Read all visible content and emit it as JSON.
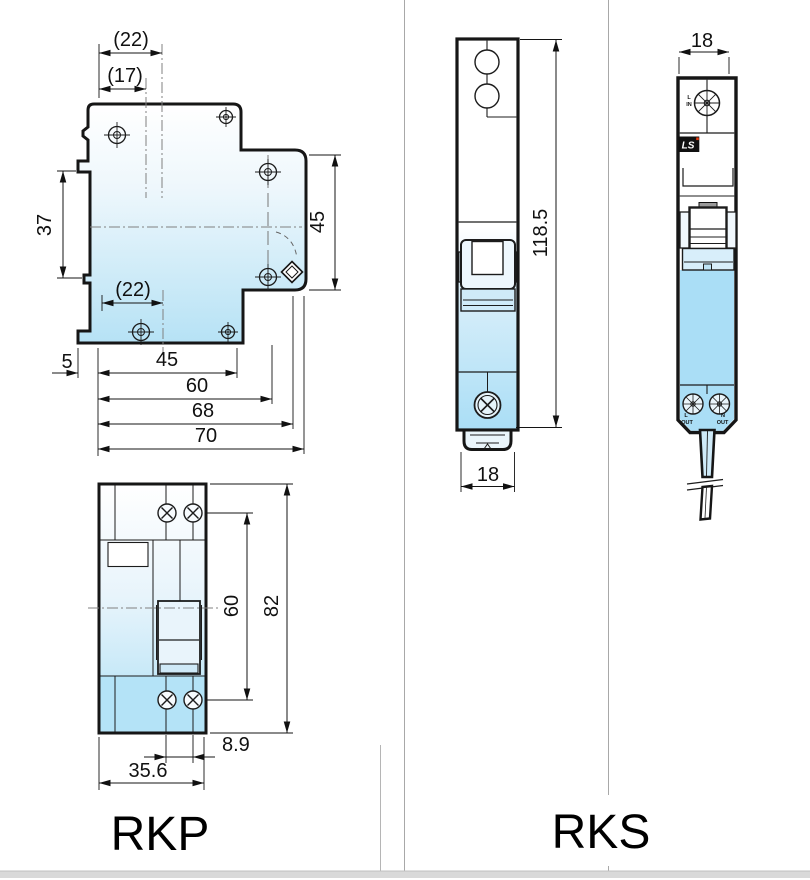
{
  "sheet": {
    "product_left": "RKP",
    "product_right": "RKS"
  },
  "colors": {
    "outline": "#161616",
    "body_fill_top": "#ffffff",
    "body_fill_bottom": "#b2e2f6",
    "solid_blue": "#aadef6",
    "centerline_gray": "#808080",
    "grid_divider": "#a8a8a8",
    "footer_bar": "#d9d9d9",
    "ls_logo_bg": "#101010",
    "ls_logo_red": "#e8380d"
  },
  "rkp_top_view": {
    "dim_width_tab_outer": "(22)",
    "dim_width_tab_inner": "(17)",
    "dim_height_left": "37",
    "dim_height_right": "45",
    "dim_width_bottom_tab": "(22)",
    "dim_lip": "5",
    "dim_width_45": "45",
    "dim_width_60": "60",
    "dim_width_68": "68",
    "dim_width_70": "70"
  },
  "rkp_front_view": {
    "dim_screw_span": "60",
    "dim_height": "82",
    "dim_screw_gap": "8.9",
    "dim_width": "35.6"
  },
  "rks_front_view": {
    "dim_height": "118.5",
    "dim_width": "18"
  },
  "rks_side_view": {
    "dim_width": "18",
    "terminal_top_line1": "L",
    "terminal_top_line2": "IN",
    "brand": "LS",
    "terminal_bottom_left_line1": "L",
    "terminal_bottom_left_line2": "OUT",
    "terminal_bottom_right_line1": "N",
    "terminal_bottom_right_line2": "OUT"
  }
}
